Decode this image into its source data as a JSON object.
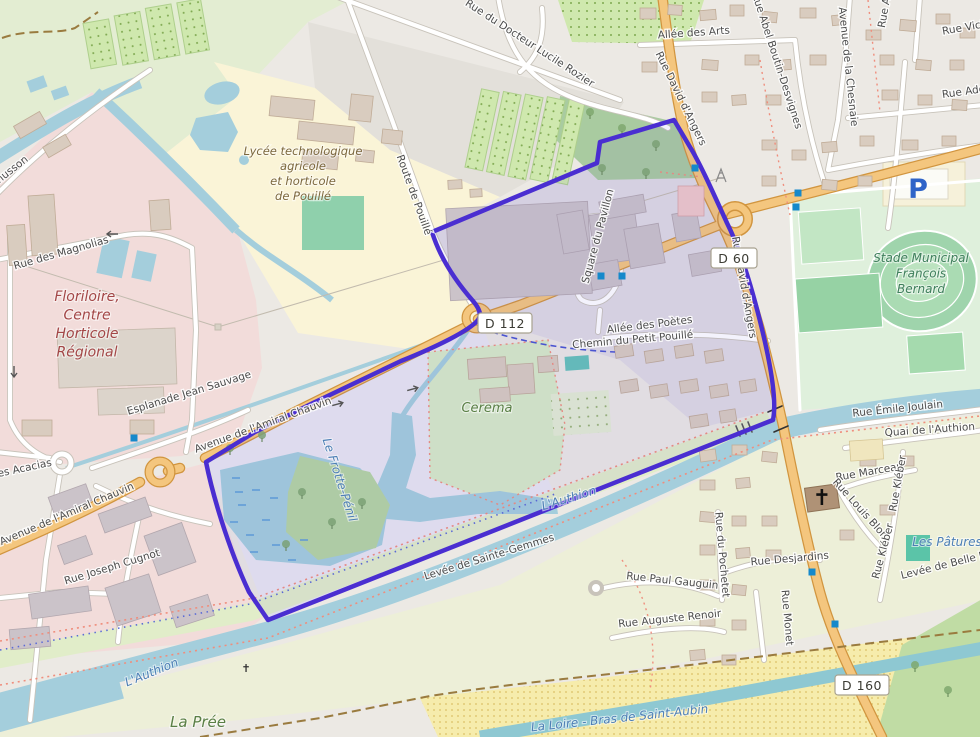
{
  "map": {
    "kind": "openstreetmap-carto-style map with selected area polygon",
    "selection_color": "#4A2ED1",
    "road_badges": [
      {
        "label": "D 112",
        "x": 505,
        "y": 324
      },
      {
        "label": "D 60",
        "x": 734,
        "y": 259
      },
      {
        "label": "D 160",
        "x": 862,
        "y": 686
      }
    ],
    "street_labels": [
      {
        "t": "Allée des Arts",
        "x": 694,
        "y": 36,
        "r": -4
      },
      {
        "t": "Rue du Docteur Lucile Rozier",
        "x": 528,
        "y": 46,
        "r": 33
      },
      {
        "t": "Rue Abel Boutin-Desvignes",
        "x": 774,
        "y": 62,
        "r": 72
      },
      {
        "t": "Avenue de la Chesnaie",
        "x": 845,
        "y": 67,
        "r": 84
      },
      {
        "t": "Rue An",
        "x": 888,
        "y": 10,
        "r": -80
      },
      {
        "t": "Rue Vict",
        "x": 964,
        "y": 31,
        "r": -10
      },
      {
        "t": "Rue Ado",
        "x": 964,
        "y": 95,
        "r": -8
      },
      {
        "t": "Rue David d'Angers",
        "x": 678,
        "y": 100,
        "r": 64
      },
      {
        "t": "Rue David d'Angers",
        "x": 741,
        "y": 288,
        "r": 80
      },
      {
        "t": "Route de Pouillé",
        "x": 411,
        "y": 196,
        "r": 70
      },
      {
        "t": "husson",
        "x": 14,
        "y": 172,
        "r": -38
      },
      {
        "t": "Rue des Magnolias",
        "x": 62,
        "y": 256,
        "r": -16
      },
      {
        "t": "Esplanade Jean Sauvage",
        "x": 190,
        "y": 396,
        "r": -17
      },
      {
        "t": "Avenue de l'Amiral Chauvin",
        "x": 264,
        "y": 428,
        "r": -20
      },
      {
        "t": "Avenue de l'Amiral Chauvin",
        "x": 68,
        "y": 517,
        "r": -23
      },
      {
        "t": "des Acacias",
        "x": 22,
        "y": 472,
        "r": -12
      },
      {
        "t": "Rue Joseph Cugnot",
        "x": 113,
        "y": 570,
        "r": -17
      },
      {
        "t": "Square du Pavillon",
        "x": 601,
        "y": 237,
        "r": -75
      },
      {
        "t": "Allée des Poètes",
        "x": 650,
        "y": 328,
        "r": -7
      },
      {
        "t": "Chemin du Petit Pouillé",
        "x": 633,
        "y": 343,
        "r": -5
      },
      {
        "t": "Rue Émile Joulain",
        "x": 898,
        "y": 412,
        "r": -6
      },
      {
        "t": "Quai de l'Authion",
        "x": 930,
        "y": 433,
        "r": -4
      },
      {
        "t": "Rue Marceau",
        "x": 870,
        "y": 475,
        "r": -10
      },
      {
        "t": "Rue Louis Blon",
        "x": 858,
        "y": 511,
        "r": 48
      },
      {
        "t": "Rue Kléber",
        "x": 901,
        "y": 484,
        "r": -80
      },
      {
        "t": "Rue Kléber",
        "x": 886,
        "y": 552,
        "r": -75
      },
      {
        "t": "Rue Desjardins",
        "x": 790,
        "y": 562,
        "r": -5
      },
      {
        "t": "Rue du Pochetet",
        "x": 719,
        "y": 555,
        "r": 85
      },
      {
        "t": "Rue Paul Gauguin",
        "x": 672,
        "y": 584,
        "r": 6
      },
      {
        "t": "Rue Auguste Renoir",
        "x": 670,
        "y": 622,
        "r": -6
      },
      {
        "t": "Rue Monet",
        "x": 784,
        "y": 618,
        "r": 85
      },
      {
        "t": "Levée de Sainte-Gemmes",
        "x": 490,
        "y": 560,
        "r": -17
      },
      {
        "t": "Levée de Belle Pou",
        "x": 950,
        "y": 567,
        "r": -14
      }
    ],
    "water_labels": [
      {
        "t": "L'Authion",
        "x": 153,
        "y": 676,
        "r": -22
      },
      {
        "t": "L'Authion",
        "x": 570,
        "y": 502,
        "r": -17
      },
      {
        "t": "Le Frotte-Pénil",
        "x": 336,
        "y": 481,
        "r": 72
      },
      {
        "t": "La Loire - Bras de Saint-Aubin",
        "x": 620,
        "y": 722,
        "r": -6
      },
      {
        "t": "Les Pâtures",
        "x": 947,
        "y": 546,
        "r": 0
      }
    ],
    "area_labels": [
      {
        "id": "lycee",
        "lines": [
          "Lycée technologique",
          "agricole",
          "et horticole",
          "de Pouillé"
        ],
        "x": 303,
        "y": 155,
        "color": "#7C683E",
        "size": 11.5,
        "lh": 15
      },
      {
        "id": "floriloire",
        "lines": [
          "Floriloire,",
          "Centre",
          "Horticole",
          "Régional"
        ],
        "x": 87,
        "y": 301,
        "color": "#A34747",
        "size": 14,
        "lh": 18.5
      },
      {
        "id": "stade",
        "lines": [
          "Stade Municipal",
          "François",
          "Bernard"
        ],
        "x": 921,
        "y": 262,
        "color": "#3F7F5C",
        "size": 12,
        "lh": 15.5
      },
      {
        "id": "cerema",
        "lines": [
          "Cerema"
        ],
        "x": 487,
        "y": 412,
        "color": "#5A7F46",
        "size": 13,
        "lh": 15
      },
      {
        "id": "la-pree",
        "lines": [
          "La Prée"
        ],
        "x": 198,
        "y": 727,
        "color": "#5A7F46",
        "size": 15,
        "lh": 16
      }
    ],
    "poi": {
      "parking_label": "P",
      "church_glyph": "✝",
      "memorial_glyph": "✝"
    }
  }
}
